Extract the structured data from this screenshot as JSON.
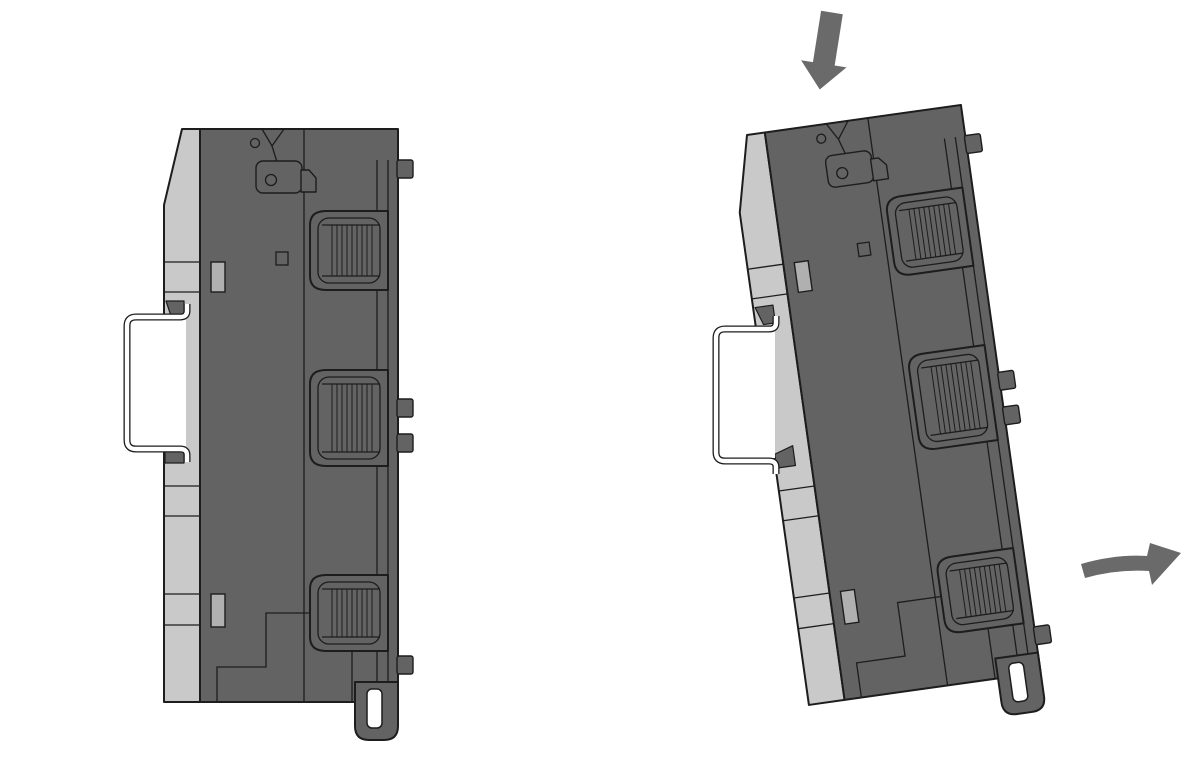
{
  "diagram": {
    "type": "technical-illustration",
    "subject": "DIN-rail module mounting and removal, side views",
    "figures": [
      {
        "id": "left",
        "label": "module latched vertically on DIN rail (side view)"
      },
      {
        "id": "right",
        "label": "module tilted on DIN rail while mounting/removing (side view)"
      }
    ],
    "arrows": [
      {
        "name": "press-down-arrow",
        "direction": "down",
        "meaning": "press module downward onto rail"
      },
      {
        "name": "swing-out-arrow",
        "direction": "right-curved",
        "meaning": "swing module bottom outward"
      }
    ],
    "colors": {
      "body": "#636363",
      "plate": "#c9c9c9",
      "slot": "#b0b0b0",
      "outline": "#1d1d1d",
      "rail": "#ffffff",
      "arrow": "#6a6a6a",
      "background": "#ffffff"
    }
  }
}
